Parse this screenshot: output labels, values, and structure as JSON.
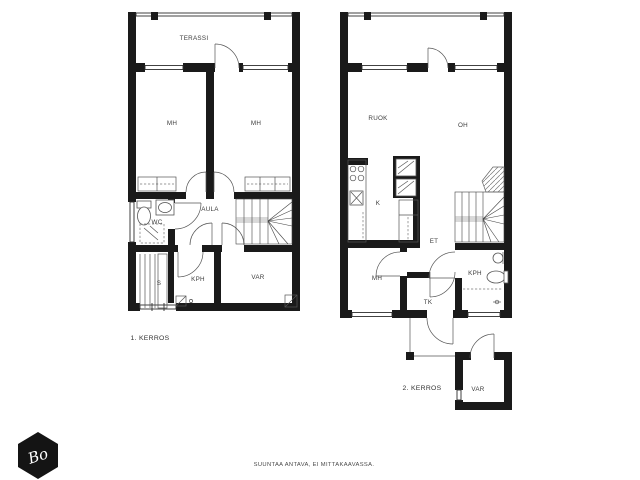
{
  "plan1": {
    "floor_label": "1. KERROS",
    "rooms": {
      "terassi": "TERASSI",
      "mh_left": "MH",
      "mh_right": "MH",
      "wc": "WC",
      "aula": "AULA",
      "kph": "KPH",
      "sauna": "S",
      "var": "VAR"
    }
  },
  "plan2": {
    "floor_label": "2. KERROS",
    "rooms": {
      "ruok": "RUOK",
      "oh": "OH",
      "kitchen": "K",
      "et": "ET",
      "mh": "MH",
      "tk": "TK",
      "kph": "KPH",
      "var": "VAR"
    }
  },
  "footer": {
    "disclaimer": "SUUNTAA ANTAVA, EI MITTAKAAVASSA."
  },
  "logo": {
    "monogram": "Bo"
  },
  "colors": {
    "wall": "#1a1a1a",
    "line": "#2e2e2e",
    "label": "#3d3d3d",
    "background": "#ffffff"
  }
}
